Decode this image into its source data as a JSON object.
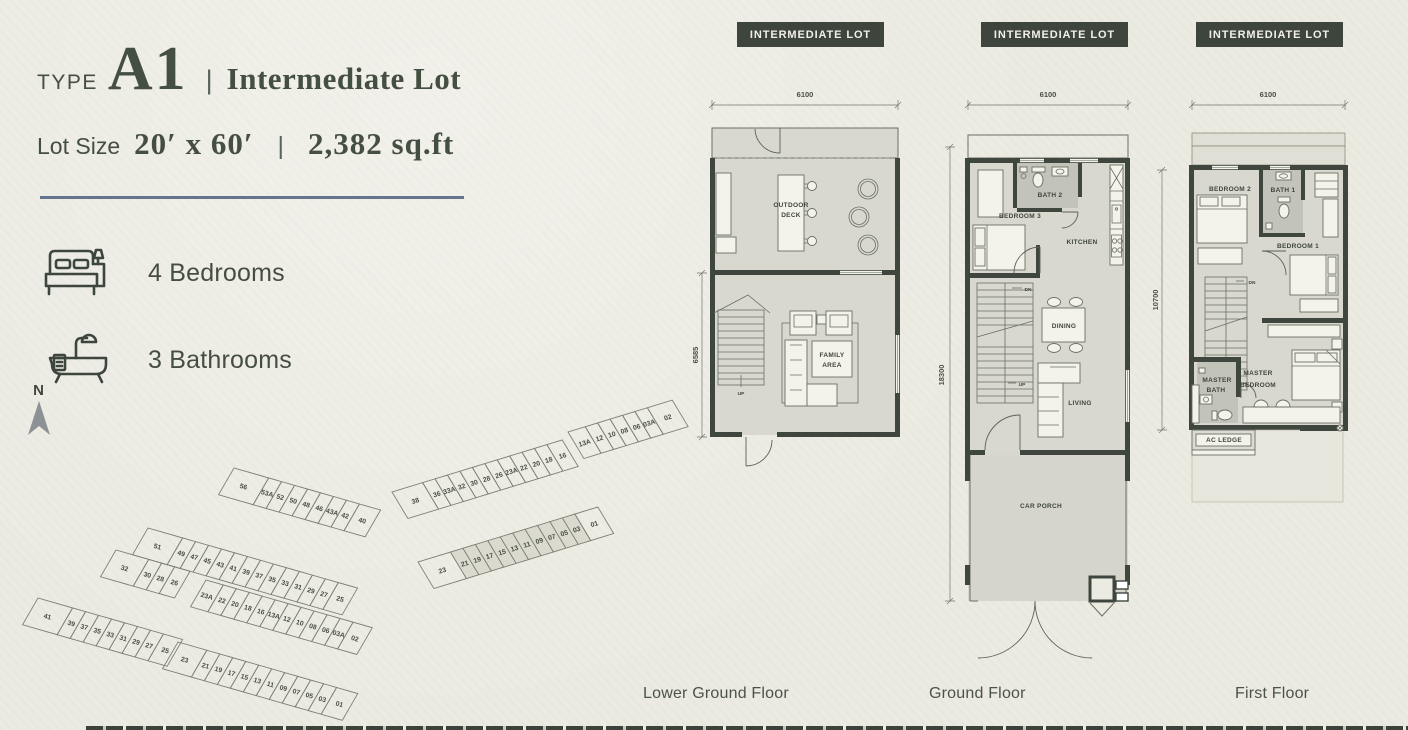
{
  "header": {
    "type_label": "TYPE",
    "type_value": "A1",
    "separator": "|",
    "lot_type": "Intermediate Lot",
    "size_label": "Lot Size",
    "size_value": "20′ x 60′",
    "size_separator": "|",
    "area": "2,382 sq.ft"
  },
  "features": [
    {
      "icon": "bed-icon",
      "label": "4 Bedrooms"
    },
    {
      "icon": "bathtub-icon",
      "label": "3 Bathrooms"
    }
  ],
  "compass": {
    "label": "N"
  },
  "plans": {
    "lower_ground": {
      "badge": "INTERMEDIATE LOT",
      "name": "Lower Ground Floor",
      "dim_width": "6100",
      "dim_depth": "6585",
      "rooms": {
        "outdoor_deck": [
          "OUTDOOR",
          "DECK"
        ],
        "family_area": [
          "FAMILY",
          "AREA"
        ]
      },
      "stairs": {
        "up": "UP"
      }
    },
    "ground": {
      "badge": "INTERMEDIATE LOT",
      "name": "Ground Floor",
      "dim_width": "6100",
      "dim_depth": "18300",
      "rooms": {
        "bedroom3": "BEDROOM 3",
        "bath2": "BATH 2",
        "kitchen": "KITCHEN",
        "dining": "DINING",
        "living": "LIVING",
        "car_porch": "CAR PORCH"
      },
      "stairs": {
        "dn": "DN",
        "up": "UP"
      }
    },
    "first": {
      "badge": "INTERMEDIATE LOT",
      "name": "First Floor",
      "dim_width": "6100",
      "dim_depth": "10700",
      "rooms": {
        "bedroom2": "BEDROOM 2",
        "bath1": "BATH 1",
        "bedroom1": "BEDROOM 1",
        "master_bath": [
          "MASTER",
          "BATH"
        ],
        "master_bedroom": [
          "MASTER",
          "BEDROOM"
        ],
        "ac_ledge": "AC LEDGE"
      },
      "stairs": {
        "dn": "DN"
      }
    }
  },
  "site_map": {
    "north_label": "N",
    "highlight_color": "#dbdacf",
    "rows": [
      {
        "x": 214,
        "y": 88,
        "angle": 16,
        "skew": -14,
        "h": 30,
        "cw": 13.5,
        "cells": [
          {
            "n": "56",
            "w": 36
          },
          {
            "n": "53A"
          },
          {
            "n": "52"
          },
          {
            "n": "50"
          },
          {
            "n": "48"
          },
          {
            "n": "46"
          },
          {
            "n": "43A"
          },
          {
            "n": "42"
          },
          {
            "n": "40",
            "w": 22
          }
        ]
      },
      {
        "x": 128,
        "y": 148,
        "angle": 16,
        "skew": -14,
        "h": 30,
        "cw": 13.5,
        "cells": [
          {
            "n": "51",
            "w": 36
          },
          {
            "n": "49"
          },
          {
            "n": "47"
          },
          {
            "n": "45"
          },
          {
            "n": "43"
          },
          {
            "n": "41"
          },
          {
            "n": "39"
          },
          {
            "n": "37"
          },
          {
            "n": "35"
          },
          {
            "n": "33"
          },
          {
            "n": "31"
          },
          {
            "n": "29"
          },
          {
            "n": "27"
          },
          {
            "n": "25",
            "w": 20
          }
        ]
      },
      {
        "x": 96,
        "y": 170,
        "angle": 16,
        "skew": -14,
        "h": 30,
        "cw": 13.5,
        "cells": [
          {
            "n": "32",
            "w": 34
          },
          {
            "n": "30"
          },
          {
            "n": "28"
          },
          {
            "n": "26",
            "w": 16
          }
        ]
      },
      {
        "x": 186,
        "y": 200,
        "angle": 16,
        "skew": -14,
        "h": 30,
        "cw": 13.5,
        "cells": [
          {
            "n": "23A",
            "w": 18
          },
          {
            "n": "22"
          },
          {
            "n": "20"
          },
          {
            "n": "18"
          },
          {
            "n": "16"
          },
          {
            "n": "13A"
          },
          {
            "n": "12"
          },
          {
            "n": "10"
          },
          {
            "n": "08"
          },
          {
            "n": "06"
          },
          {
            "n": "03A"
          },
          {
            "n": "02",
            "w": 20
          }
        ]
      },
      {
        "x": 18,
        "y": 218,
        "angle": 16,
        "skew": -14,
        "h": 30,
        "cw": 13.5,
        "cells": [
          {
            "n": "41",
            "w": 36
          },
          {
            "n": "39"
          },
          {
            "n": "37"
          },
          {
            "n": "35"
          },
          {
            "n": "33"
          },
          {
            "n": "31"
          },
          {
            "n": "29"
          },
          {
            "n": "27"
          },
          {
            "n": "25",
            "w": 20
          }
        ]
      },
      {
        "x": 158,
        "y": 262,
        "angle": 16,
        "skew": -14,
        "h": 30,
        "cw": 13.5,
        "cells": [
          {
            "n": "23",
            "w": 30
          },
          {
            "n": "21"
          },
          {
            "n": "19"
          },
          {
            "n": "17"
          },
          {
            "n": "15"
          },
          {
            "n": "13"
          },
          {
            "n": "11"
          },
          {
            "n": "09"
          },
          {
            "n": "07"
          },
          {
            "n": "05"
          },
          {
            "n": "03"
          },
          {
            "n": "01",
            "w": 22
          }
        ]
      },
      {
        "x": 372,
        "y": 112,
        "angle": -17,
        "skew": 14,
        "h": 30,
        "cw": 13,
        "cells": [
          {
            "n": "38",
            "w": 32
          },
          {
            "n": "36"
          },
          {
            "n": "33A"
          },
          {
            "n": "32"
          },
          {
            "n": "30"
          },
          {
            "n": "28"
          },
          {
            "n": "26"
          },
          {
            "n": "23A"
          },
          {
            "n": "22"
          },
          {
            "n": "20"
          },
          {
            "n": "18"
          },
          {
            "n": "16",
            "w": 16
          }
        ]
      },
      {
        "x": 548,
        "y": 52,
        "angle": -17,
        "skew": 14,
        "h": 30,
        "cw": 13,
        "cells": [
          {
            "n": "13A",
            "w": 18
          },
          {
            "n": "12"
          },
          {
            "n": "10"
          },
          {
            "n": "08"
          },
          {
            "n": "06"
          },
          {
            "n": "03A"
          },
          {
            "n": "02",
            "w": 26
          }
        ]
      },
      {
        "x": 398,
        "y": 182,
        "angle": -17,
        "skew": 14,
        "h": 30,
        "cw": 13,
        "cells": [
          {
            "n": "23",
            "w": 34
          },
          {
            "n": "21",
            "hl": 1
          },
          {
            "n": "19",
            "hl": 1
          },
          {
            "n": "17",
            "hl": 1
          },
          {
            "n": "15",
            "hl": 1
          },
          {
            "n": "13",
            "hl": 1
          },
          {
            "n": "11",
            "hl": 1
          },
          {
            "n": "09",
            "hl": 1
          },
          {
            "n": "07",
            "hl": 1
          },
          {
            "n": "05",
            "hl": 1
          },
          {
            "n": "03",
            "hl": 1
          },
          {
            "n": "01",
            "w": 24
          }
        ]
      }
    ]
  },
  "colors": {
    "background": "#ecebe2",
    "text_dark": "#454f41",
    "badge_bg": "#3d453d",
    "badge_text": "#f2f1e8",
    "divider_line": "#64748c",
    "plan_interior": "#d8d8ce",
    "bath_interior": "#c2c4b9",
    "wall": "#3e463e",
    "lot_highlight": "#dbdacf"
  }
}
